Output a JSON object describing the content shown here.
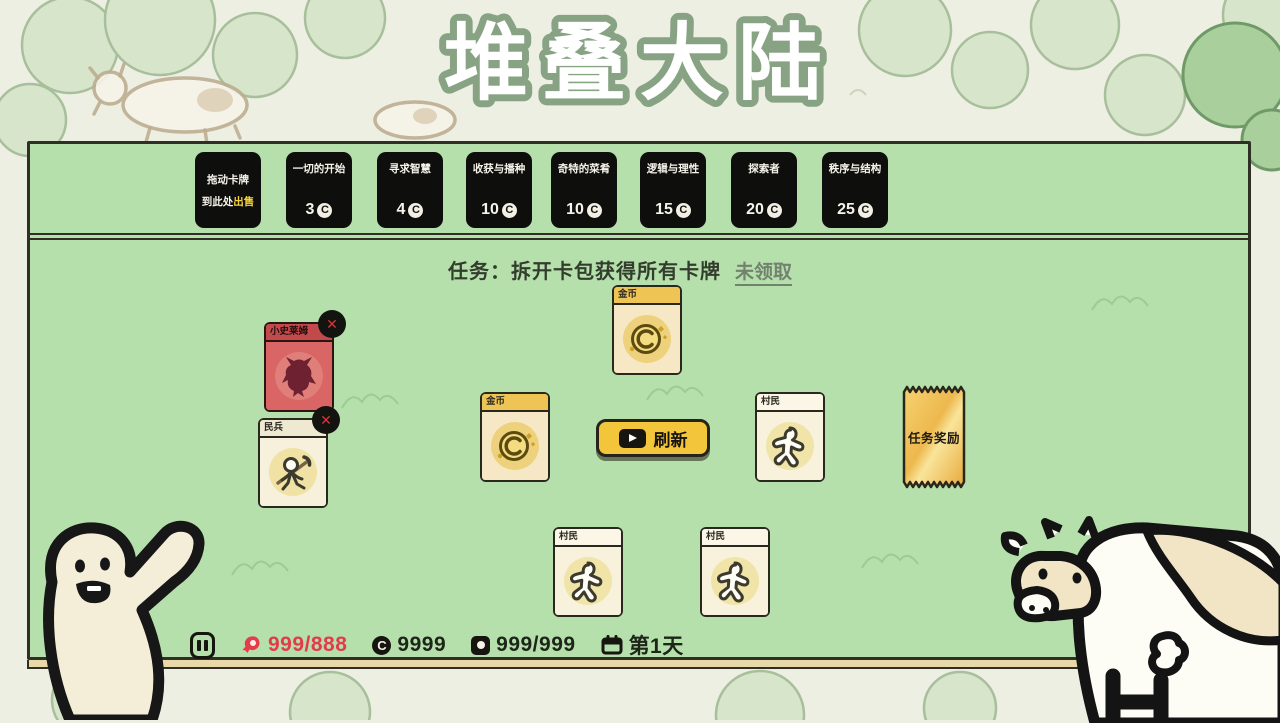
{
  "title": "堆叠大陆",
  "shop": {
    "sell_zone": {
      "line1": "拖动卡牌",
      "line2_prefix": "到此处",
      "line2_highlight": "出售"
    },
    "packs": [
      {
        "name": "一切的开始",
        "price": "3"
      },
      {
        "name": "寻求智慧",
        "price": "4"
      },
      {
        "name": "收获与播种",
        "price": "10"
      },
      {
        "name": "奇特的菜肴",
        "price": "10"
      },
      {
        "name": "逻辑与理性",
        "price": "15"
      },
      {
        "name": "探索者",
        "price": "20"
      },
      {
        "name": "秩序与结构",
        "price": "25"
      }
    ]
  },
  "quest": {
    "label": "任务：拆开卡包获得所有卡牌",
    "claim_status": "未领取"
  },
  "cards": [
    {
      "title": "金币",
      "type": "coin"
    },
    {
      "title": "小史莱姆",
      "type": "enemy"
    },
    {
      "title": "民兵",
      "type": "militia"
    },
    {
      "title": "金币",
      "type": "coin"
    },
    {
      "title": "村民",
      "type": "villager"
    },
    {
      "title": "村民",
      "type": "villager"
    },
    {
      "title": "村民",
      "type": "villager"
    }
  ],
  "buttons": {
    "refresh": "刷新"
  },
  "ticket": {
    "label": "任务奖励"
  },
  "status_bar": {
    "food": "999/888",
    "coins": "9999",
    "card_count": "999/999",
    "day": "第1天"
  },
  "icons": {
    "coin": "C-coin circle",
    "pause": "pause bars",
    "play": "play triangle",
    "attack": "✕",
    "food": "meat",
    "card_count": "card with dot",
    "day": "calendar"
  },
  "colors": {
    "board_green": "#b5e0ac",
    "pack_black": "#0e0e0c",
    "highlight_yellow": "#f6d33c",
    "refresh_yellow": "#f3c53a",
    "ticket_gold": "#edb84e",
    "danger_red": "#d8353b",
    "food_red": "#e23b49"
  }
}
